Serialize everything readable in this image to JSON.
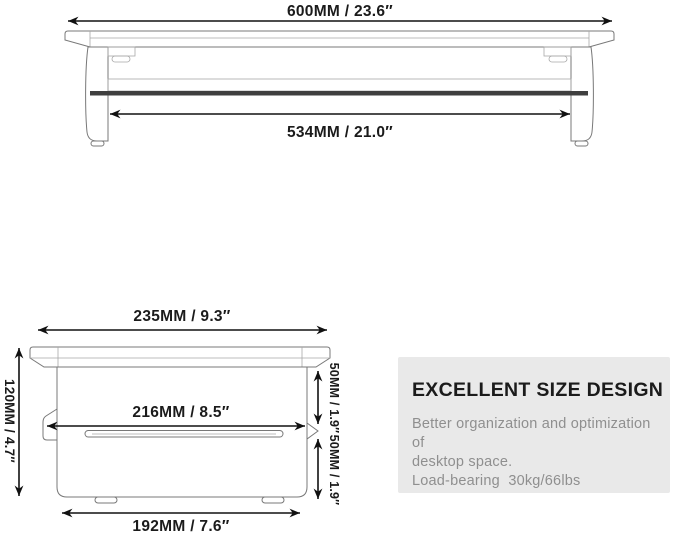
{
  "front_view": {
    "dim_top": "600MM / 23.6″",
    "dim_shelf": "534MM / 21.0″"
  },
  "side_view": {
    "dim_top": "235MM / 9.3″",
    "dim_height": "120MM / 4.7″",
    "dim_middle": "216MM / 8.5″",
    "dim_upper_right": "50MM / 1.9″",
    "dim_lower_right": "50MM / 1.9″",
    "dim_bottom": "192MM / 7.6″"
  },
  "info_box": {
    "title": "EXCELLENT SIZE DESIGN",
    "line1": "Better organization and optimization of",
    "line2": "desktop space.",
    "line3": "Load-bearing  30kg/66lbs"
  },
  "colors": {
    "background": "#ffffff",
    "dimension_lines": "#111111",
    "drawing_outline": "#787878",
    "shelf_dark_bar": "#3f3f3f",
    "info_panel_background": "#e9e9e9",
    "info_title_text": "#1b1b1b",
    "info_body_text": "#8f8f8f"
  }
}
